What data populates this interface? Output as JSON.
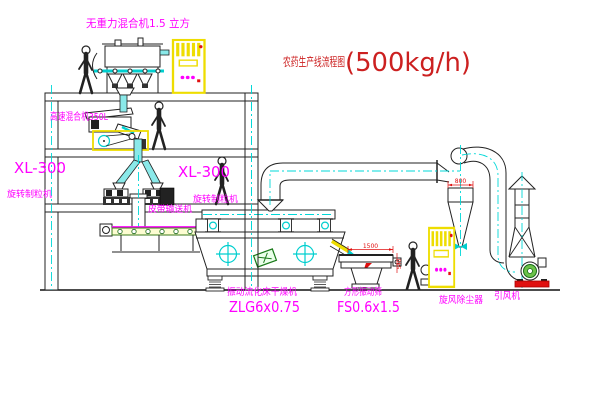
{
  "title": {
    "name": "农药生产线流程图",
    "capacity": "(500kg/h)"
  },
  "equipment": {
    "gravity_mixer": {
      "label": "无重力混合机1.5 立方"
    },
    "high_speed_mixer": {
      "label": "高速混合机350L"
    },
    "granulator_left": {
      "model": "XL-300",
      "label": "旋转制粒机"
    },
    "granulator_right": {
      "model": "XL-300",
      "label": "旋转制粒机"
    },
    "belt_conveyor": {
      "label": "皮带输送机"
    },
    "dryer": {
      "label": "振动流化床干燥机",
      "model": "ZLG6x0.75"
    },
    "sieve": {
      "label": "方形振动筛",
      "model": "FS0.6x1.5"
    },
    "cyclone": {
      "label": "旋风除尘器"
    },
    "fan": {
      "label": "引风机"
    }
  },
  "dimensions": {
    "sieve_length": "1500",
    "sieve_height": "540",
    "cyclone_diameter": "800"
  },
  "colors": {
    "label_magenta": "#ff00ff",
    "title_red": "#cc2020",
    "dimension_red": "#e01010",
    "centerline_cyan": "#00d8d8",
    "cabinet_yellow": "#eedd00",
    "fan_green": "#6cc24a",
    "base_red": "#e01010"
  }
}
